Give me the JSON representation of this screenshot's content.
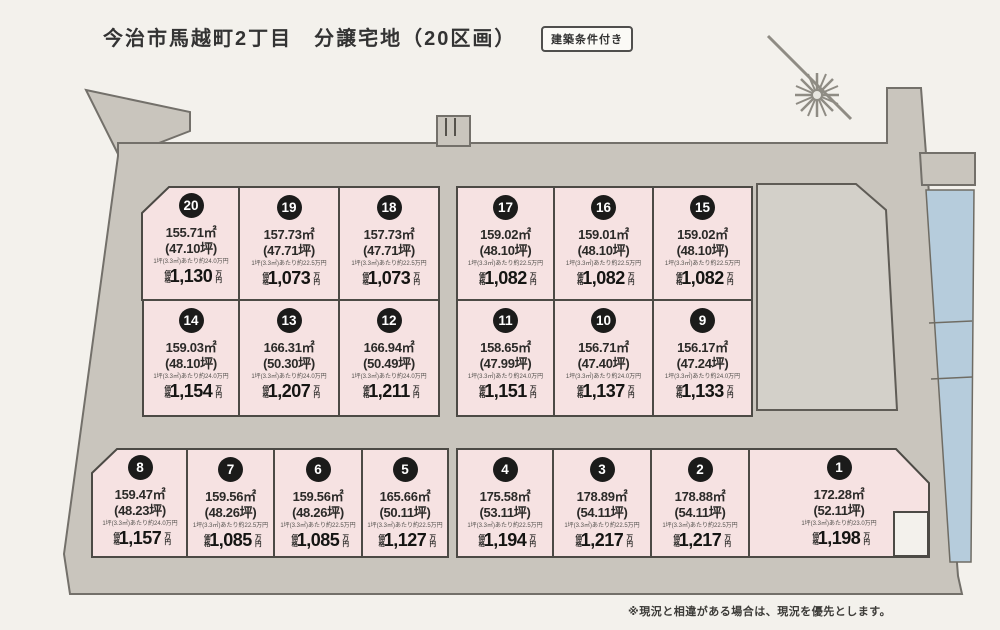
{
  "title": "今治市馬越町2丁目　分譲宅地（20区画）",
  "badge": "建築条件付き",
  "footnote": "※現況と相違がある場合は、現況を優先とします。",
  "price_prefix": "価格",
  "price_unit": "万円",
  "colors": {
    "page": "#f3f1ec",
    "road": "#c9c5bd",
    "plot_pink": "#f6e2e2",
    "reserved_parcel_gray": "#d3d0c9",
    "water_blue": "#b6ccdc",
    "plot_border": "#4c4a45"
  },
  "icons": {
    "compass": "north-compass-icon"
  },
  "plots": [
    {
      "no": "1",
      "area_m2": "172.28㎡",
      "area_tsubo": "(52.11坪)",
      "unit": "1坪(3.3㎡)あたり約23.0万円",
      "price": "1,198"
    },
    {
      "no": "2",
      "area_m2": "178.88㎡",
      "area_tsubo": "(54.11坪)",
      "unit": "1坪(3.3㎡)あたり約22.5万円",
      "price": "1,217"
    },
    {
      "no": "3",
      "area_m2": "178.89㎡",
      "area_tsubo": "(54.11坪)",
      "unit": "1坪(3.3㎡)あたり約22.5万円",
      "price": "1,217"
    },
    {
      "no": "4",
      "area_m2": "175.58㎡",
      "area_tsubo": "(53.11坪)",
      "unit": "1坪(3.3㎡)あたり約22.5万円",
      "price": "1,194"
    },
    {
      "no": "5",
      "area_m2": "165.66㎡",
      "area_tsubo": "(50.11坪)",
      "unit": "1坪(3.3㎡)あたり約22.5万円",
      "price": "1,127"
    },
    {
      "no": "6",
      "area_m2": "159.56㎡",
      "area_tsubo": "(48.26坪)",
      "unit": "1坪(3.3㎡)あたり約22.5万円",
      "price": "1,085"
    },
    {
      "no": "7",
      "area_m2": "159.56㎡",
      "area_tsubo": "(48.26坪)",
      "unit": "1坪(3.3㎡)あたり約22.5万円",
      "price": "1,085"
    },
    {
      "no": "8",
      "area_m2": "159.47㎡",
      "area_tsubo": "(48.23坪)",
      "unit": "1坪(3.3㎡)あたり約24.0万円",
      "price": "1,157"
    },
    {
      "no": "9",
      "area_m2": "156.17㎡",
      "area_tsubo": "(47.24坪)",
      "unit": "1坪(3.3㎡)あたり約24.0万円",
      "price": "1,133"
    },
    {
      "no": "10",
      "area_m2": "156.71㎡",
      "area_tsubo": "(47.40坪)",
      "unit": "1坪(3.3㎡)あたり約24.0万円",
      "price": "1,137"
    },
    {
      "no": "11",
      "area_m2": "158.65㎡",
      "area_tsubo": "(47.99坪)",
      "unit": "1坪(3.3㎡)あたり約24.0万円",
      "price": "1,151"
    },
    {
      "no": "12",
      "area_m2": "166.94㎡",
      "area_tsubo": "(50.49坪)",
      "unit": "1坪(3.3㎡)あたり約24.0万円",
      "price": "1,211"
    },
    {
      "no": "13",
      "area_m2": "166.31㎡",
      "area_tsubo": "(50.30坪)",
      "unit": "1坪(3.3㎡)あたり約24.0万円",
      "price": "1,207"
    },
    {
      "no": "14",
      "area_m2": "159.03㎡",
      "area_tsubo": "(48.10坪)",
      "unit": "1坪(3.3㎡)あたり約24.0万円",
      "price": "1,154"
    },
    {
      "no": "15",
      "area_m2": "159.02㎡",
      "area_tsubo": "(48.10坪)",
      "unit": "1坪(3.3㎡)あたり約22.5万円",
      "price": "1,082"
    },
    {
      "no": "16",
      "area_m2": "159.01㎡",
      "area_tsubo": "(48.10坪)",
      "unit": "1坪(3.3㎡)あたり約22.5万円",
      "price": "1,082"
    },
    {
      "no": "17",
      "area_m2": "159.02㎡",
      "area_tsubo": "(48.10坪)",
      "unit": "1坪(3.3㎡)あたり約22.5万円",
      "price": "1,082"
    },
    {
      "no": "18",
      "area_m2": "157.73㎡",
      "area_tsubo": "(47.71坪)",
      "unit": "1坪(3.3㎡)あたり約22.5万円",
      "price": "1,073"
    },
    {
      "no": "19",
      "area_m2": "157.73㎡",
      "area_tsubo": "(47.71坪)",
      "unit": "1坪(3.3㎡)あたり約22.5万円",
      "price": "1,073"
    },
    {
      "no": "20",
      "area_m2": "155.71㎡",
      "area_tsubo": "(47.10坪)",
      "unit": "1坪(3.3㎡)あたり約24.0万円",
      "price": "1,130"
    }
  ]
}
